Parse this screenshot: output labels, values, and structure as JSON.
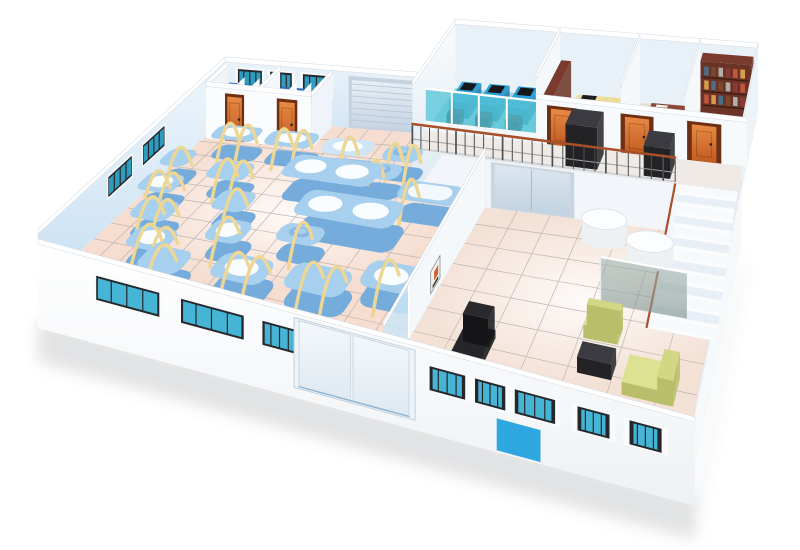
{
  "meta": {
    "type": "3d-isometric-facility-floorplan",
    "description": "3D isometric cutaway rendering of a factory facility: production hall with blue machines and yellow pipes, staff stalls room, mezzanine offices with cubicles and desks, staircase, lounge area with sofa set",
    "width": 800,
    "height": 550
  },
  "palette": {
    "machineTop": "#a7cfee",
    "machineSide": "#76acdc",
    "machineTopLight": "#cfe4f6",
    "machineSideLight": "#9cc2e4",
    "ovalWhite": "#fafdff",
    "bigTop": "#f2f9fd",
    "pipe": "#eed694",
    "handleBand": "#8ab8e2",
    "glassBack": "#2e9cbe",
    "glassFront": "#46b4d4",
    "frame": "#26272b",
    "trim": "#f8fafc",
    "floorProd": "#f6ddd0",
    "floorHall": "#f4e1d6",
    "grid": "#bdb6b1",
    "cubFloor": "#9ed3df",
    "cubGlass": "rgba(88,198,216,0.78)",
    "cubDesk": "#2ba0d6",
    "cubDeskSide": "#1b7cab",
    "roomFloor2": "#eae2d9",
    "roomFloor3": "#e8e0d6",
    "roomFloor4": "#e7dfd5",
    "corrFloor": "#efeae5",
    "deskYTop": "#eedd96",
    "deskYSide": "#d6bf72",
    "shelf": "#6b3326",
    "shelfSide": "#4a2118",
    "shelfTop": "#7a3b2e",
    "shelfLine": "#3a1a10",
    "mahTop": "#8a4835",
    "mahSide": "#5f2d20",
    "dark": "#232326",
    "darkTop": "#3b3b41",
    "darkSide": "#141416",
    "sofaTop": "#dde293",
    "sofaSide": "#b9be6a",
    "sofaBack": "#d2d784",
    "cylSide": "#eef1f4",
    "cylTop": "#fcfdff",
    "cylBase": "#d7dde1",
    "railTop": "#a8502a",
    "railBar": "#4b5056",
    "railMid": "#9aa0a6",
    "railBase": "#c9cfd4",
    "stepA": "#e8eff6",
    "stepB": "#f7fafc",
    "stringer": "#f4f7fa",
    "blueDoor": "#2ea7e0",
    "posterBg": "#f4f1ea",
    "posterOrange": "#cf6434",
    "partGlass": "rgba(202,229,246,0.85)",
    "wallWhite": "#fbfcfd",
    "supportWall": "#f2f6fa",
    "mezzBack": "#e8f1f8",
    "divider": "#f5f8fb",
    "stallBlue": "#2f6fbc",
    "stallBlueLight": "#74a9dc",
    "stallWall": "#eef4f9",
    "doorFrame": "#6e2f12",
    "knob": "#3a1d0a",
    "bookColors": [
      "#c0563a",
      "#d89b4a",
      "#4a6f8a",
      "#7a4a2e",
      "#b0b0a8",
      "#8a3a3a"
    ]
  },
  "projection": {
    "bl": [
      225,
      118
    ],
    "br": [
      758,
      160
    ],
    "fl": [
      38,
      290
    ],
    "fr": [
      695,
      468
    ],
    "wallH": 56,
    "mezzZ": 48,
    "mezzTop": 112
  },
  "production": {
    "floor": [
      0,
      0,
      0.65,
      1
    ],
    "backWindows": [
      [
        0.035,
        0.098
      ],
      [
        0.119,
        0.173
      ],
      [
        0.2,
        0.264
      ]
    ],
    "leftWindows": [
      [
        0.38,
        0.5
      ],
      [
        0.56,
        0.68
      ]
    ],
    "rollupDoor": [
      0.313,
      0.457
    ],
    "machines": [
      {
        "b": [
          0.06,
          0.17,
          0.17,
          0.26
        ],
        "o": 1,
        "p": [
          0.3,
          0.7
        ]
      },
      {
        "b": [
          0.19,
          0.17,
          0.3,
          0.26
        ],
        "o": 1,
        "p": [
          0.3,
          0.7
        ]
      },
      {
        "b": [
          0.32,
          0.18,
          0.42,
          0.27
        ],
        "o": 1,
        "l": 1,
        "p": [
          0.5
        ]
      },
      {
        "b": [
          0.445,
          0.19,
          0.515,
          0.27
        ],
        "hd": 1,
        "p": [
          0.25,
          0.75
        ]
      },
      {
        "b": [
          0.43,
          0.285,
          0.5,
          0.365
        ],
        "hd": 1,
        "p": [
          0.3
        ]
      },
      {
        "b": [
          0.29,
          0.31,
          0.47,
          0.43
        ],
        "o": 2,
        "h": 24
      },
      {
        "b": [
          0.37,
          0.47,
          0.55,
          0.59
        ],
        "o": 2,
        "h": 24
      },
      {
        "b": [
          0.52,
          0.36,
          0.625,
          0.45
        ],
        "o": 3,
        "h": 22,
        "p": [
          0.15
        ]
      },
      {
        "b": [
          0.005,
          0.34,
          0.075,
          0.44
        ],
        "p": [
          0.5
        ]
      },
      {
        "b": [
          0.015,
          0.48,
          0.105,
          0.58
        ],
        "o": 1,
        "p": [
          0.35,
          0.75
        ]
      },
      {
        "b": [
          0.06,
          0.61,
          0.15,
          0.71
        ],
        "p": [
          0.35,
          0.75
        ]
      },
      {
        "b": [
          0.11,
          0.73,
          0.2,
          0.83
        ],
        "o": 1,
        "p": [
          0.35,
          0.75
        ]
      },
      {
        "b": [
          0.17,
          0.8,
          0.26,
          0.9
        ],
        "p": [
          0.4
        ]
      },
      {
        "b": [
          0.135,
          0.37,
          0.225,
          0.47
        ],
        "p": [
          0.35,
          0.75
        ]
      },
      {
        "b": [
          0.205,
          0.51,
          0.28,
          0.61
        ],
        "p": [
          0.5
        ]
      },
      {
        "b": [
          0.245,
          0.64,
          0.32,
          0.74
        ],
        "o": 1,
        "p": [
          0.4
        ]
      },
      {
        "b": [
          0.31,
          0.77,
          0.41,
          0.87
        ],
        "o": 1,
        "p": [
          0.35,
          0.75
        ]
      },
      {
        "b": [
          0.44,
          0.75,
          0.54,
          0.85
        ],
        "p": [
          0.35,
          0.75
        ]
      },
      {
        "b": [
          0.55,
          0.69,
          0.635,
          0.79
        ],
        "o": 1,
        "p": [
          0.4
        ]
      },
      {
        "b": [
          0.37,
          0.61,
          0.45,
          0.69
        ],
        "hd": 1,
        "p": [
          0.5
        ]
      }
    ]
  },
  "stalls": {
    "room": [
      0.008,
      0,
      0.268,
      0.145
    ],
    "dividerU": 0.144,
    "sections": [
      [
        0.018,
        0.134
      ],
      [
        0.154,
        0.258
      ]
    ],
    "doors": [
      [
        0.064,
        0.101
      ],
      [
        0.193,
        0.229
      ]
    ]
  },
  "mezzanine": {
    "startU": 0.526,
    "corridorV": [
      0.24,
      0.34
    ],
    "rooms": [
      [
        0.526,
        0.712
      ],
      [
        0.712,
        0.837
      ],
      [
        0.837,
        0.923
      ],
      [
        0.923,
        1.0
      ]
    ],
    "slidingDoor": [
      0.665,
      0.779
    ],
    "corridorDoors": [
      [
        0.735,
        0.768
      ],
      [
        0.843,
        0.876
      ],
      [
        0.932,
        0.963
      ]
    ],
    "cabinets": [
      {
        "b": [
          0.77,
          0.255,
          0.815,
          0.325
        ],
        "h": 42
      },
      {
        "b": [
          0.878,
          0.26,
          0.912,
          0.325
        ],
        "h": 30
      }
    ],
    "cubicleDesks": [
      [
        0.55,
        0.585
      ],
      [
        0.6,
        0.635
      ],
      [
        0.65,
        0.685
      ]
    ],
    "yellowDesks": [
      [
        0.75,
        0.06,
        0.82,
        0.1
      ],
      [
        0.75,
        0.13,
        0.82,
        0.17
      ]
    ],
    "railing": {
      "u": [
        0.526,
        0.92
      ],
      "v": 0.34,
      "bars": 26
    }
  },
  "stairs": {
    "u": [
      0.92,
      0.995
    ],
    "vTop": 0.34,
    "vBot": 0.68,
    "steps": 13
  },
  "hall": {
    "partitionU": 0.65,
    "partitionGlassV": [
      0.86,
      1.0
    ],
    "posterV": [
      0.67,
      0.73
    ],
    "cylinders": [
      {
        "c": [
          0.835,
          0.405
        ],
        "ru": 0.03,
        "rv": 0.04,
        "h": 20
      },
      {
        "c": [
          0.9,
          0.46
        ],
        "ru": 0.029,
        "rv": 0.038,
        "h": 19
      }
    ],
    "glassScreen": {
      "u": [
        0.86,
        0.96
      ],
      "v": 0.63,
      "h": 46
    },
    "armchair": {
      "seat": [
        0.855,
        0.7,
        0.895,
        0.745
      ],
      "back": [
        0.855,
        0.695,
        0.895,
        0.715
      ]
    },
    "sofa": {
      "seat": [
        0.915,
        0.8,
        0.965,
        0.875
      ],
      "back": [
        0.952,
        0.8,
        0.968,
        0.875
      ]
    },
    "table": [
      0.862,
      0.8,
      0.9,
      0.845
    ],
    "examChair": {
      "seat": [
        0.715,
        0.8,
        0.755,
        0.9
      ],
      "back": [
        0.718,
        0.79,
        0.752,
        0.83
      ]
    },
    "mat": [
      0.875,
      0.93,
      0.915,
      0.96
    ]
  },
  "frontWall": {
    "windows": [
      [
        0.14,
        0.275
      ],
      [
        0.318,
        0.433
      ],
      [
        0.465,
        0.522
      ],
      [
        0.712,
        0.757
      ],
      [
        0.769,
        0.805
      ],
      [
        0.816,
        0.861
      ],
      [
        0.885,
        0.918
      ],
      [
        0.938,
        0.969
      ]
    ],
    "glassDoor": [
      0.525,
      0.685
    ],
    "blueDoor": [
      0.795,
      0.845
    ]
  }
}
